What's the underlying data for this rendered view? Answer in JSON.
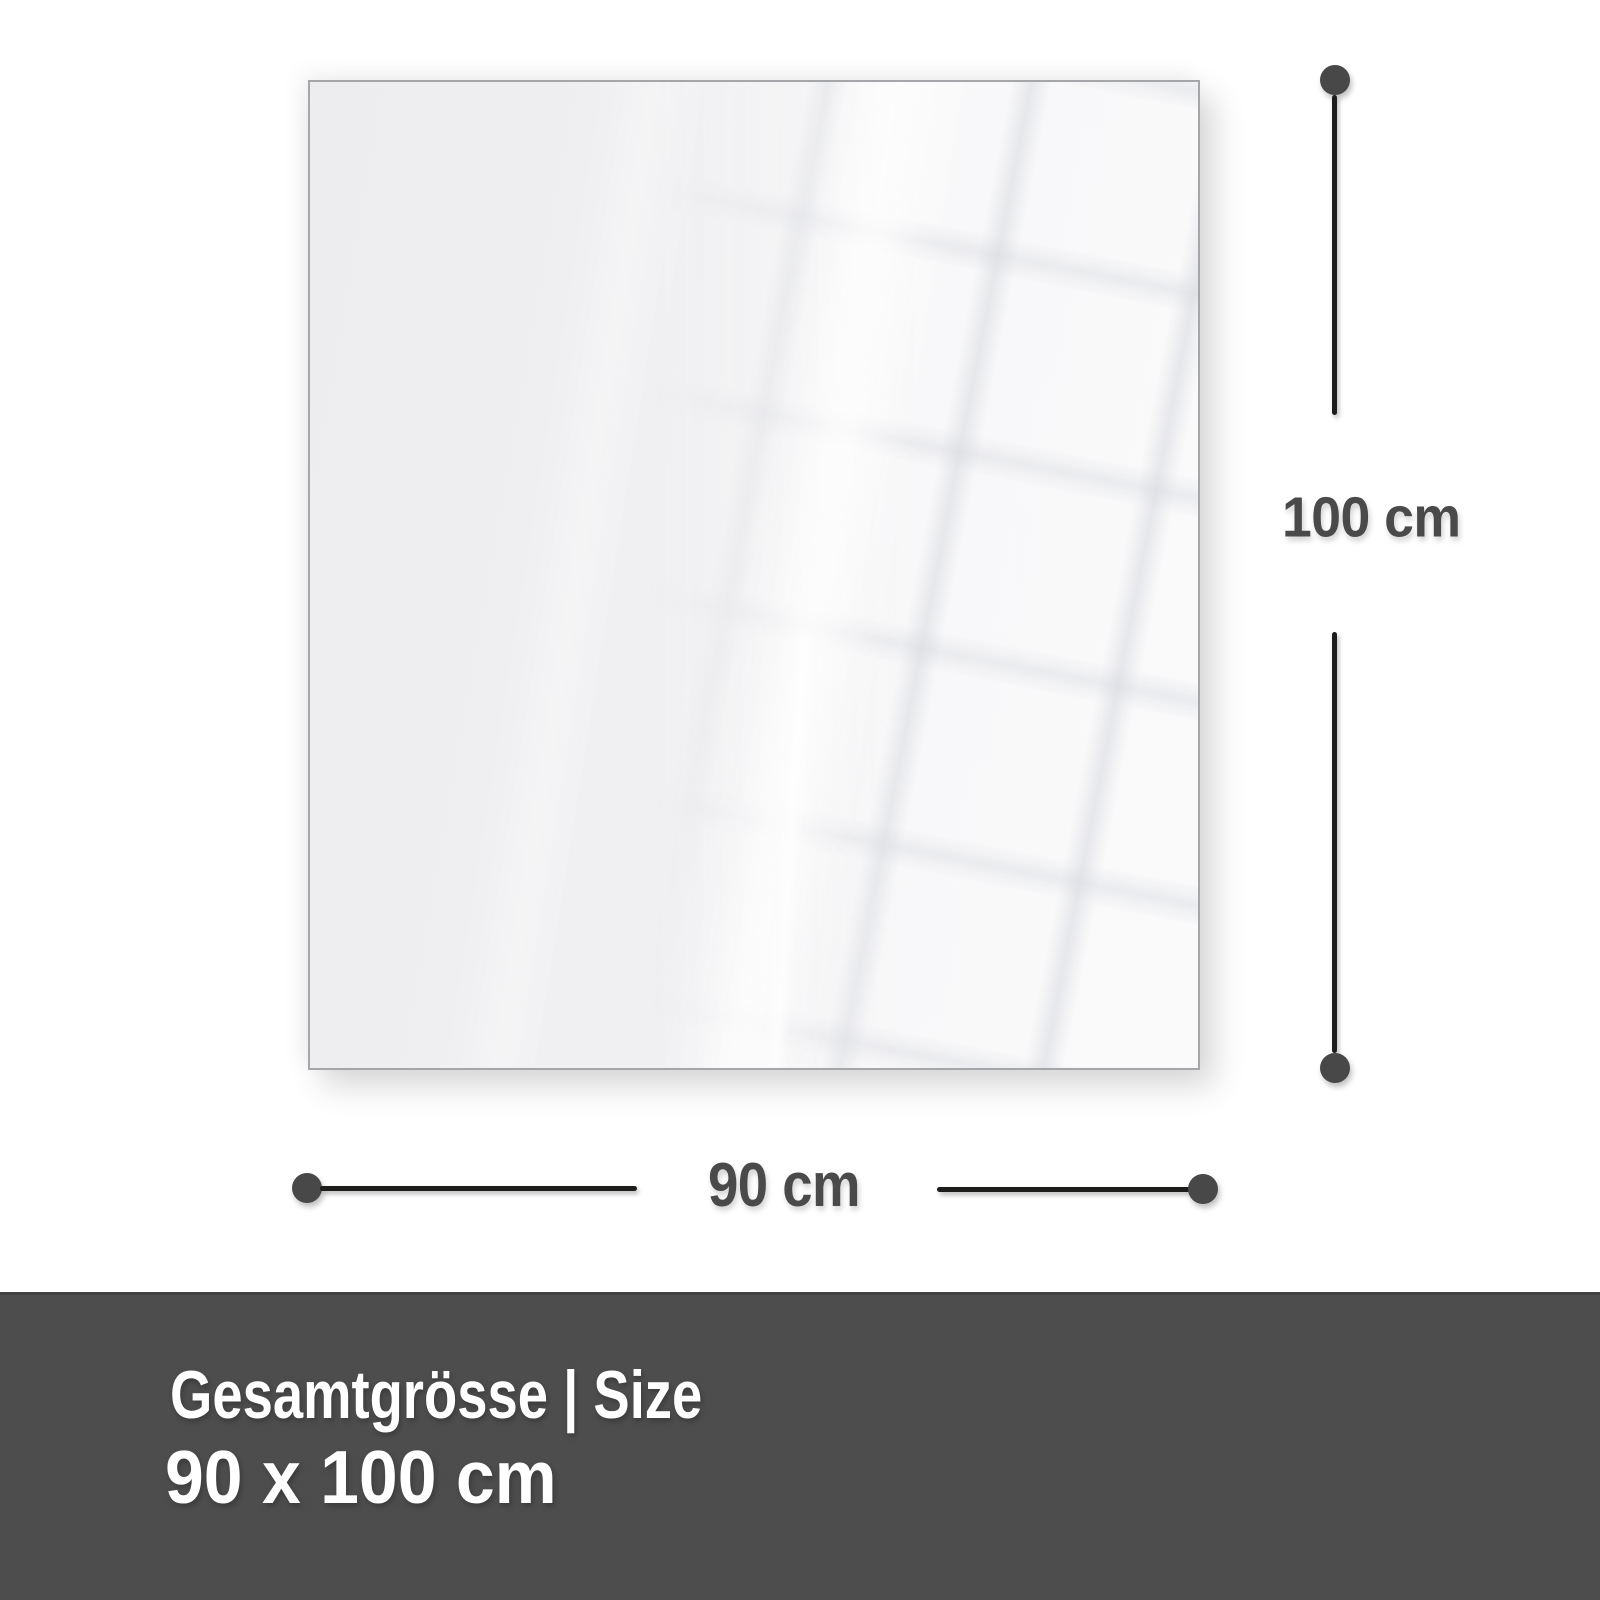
{
  "diagram": {
    "vertical_dimension_label": "100 cm",
    "horizontal_dimension_label": "90 cm"
  },
  "footer": {
    "heading": "Gesamtgrösse | Size",
    "size_value": "90 x 100 cm"
  },
  "colors": {
    "dimension_line": "#1d1d1b",
    "dimension_dot": "#484848",
    "dimension_text": "#4a4a4a",
    "panel_fill": "#f0f0f2",
    "panel_border": "#a5a6aa",
    "footer_background": "#4d4d4d",
    "footer_text": "#ffffff"
  }
}
